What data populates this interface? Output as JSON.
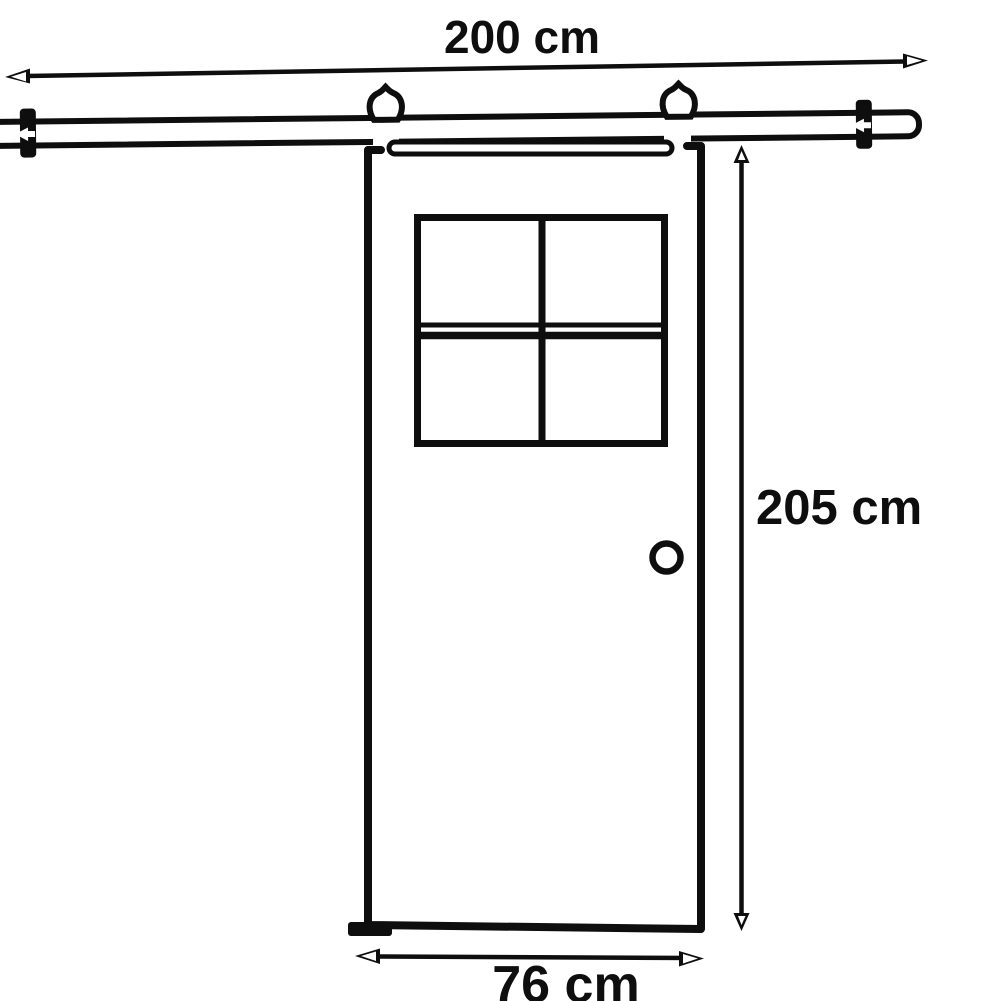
{
  "diagram": {
    "type": "product-dimension-diagram",
    "subject": "sliding barn door on overhead rail with 4-pane window and round knob",
    "colors": {
      "background": "#ffffff",
      "line": "#0e0e0e"
    },
    "labels": {
      "rail_width": "200 cm",
      "door_height": "205 cm",
      "door_width": "76 cm"
    }
  }
}
